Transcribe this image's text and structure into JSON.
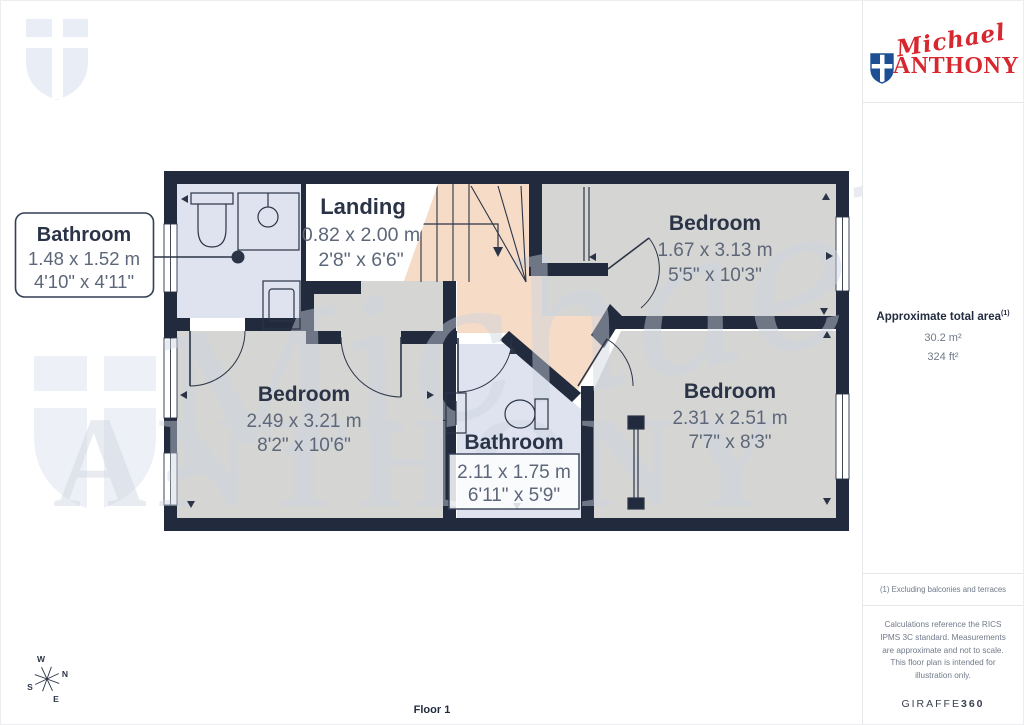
{
  "branding": {
    "script": "Michael",
    "name": "ANTHONY",
    "logo_red": "#d7282f",
    "shield_navy": "#1d4f94"
  },
  "sidebar": {
    "area": {
      "title": "Approximate total area",
      "sup": "(1)",
      "m2": "30.2 m²",
      "ft2": "324 ft²"
    },
    "footnote": "(1) Excluding balconies and terraces",
    "disclaimer": "Calculations reference the RICS IPMS 3C standard. Measurements are approximate and not to scale. This floor plan is intended for illustration only.",
    "provider": {
      "name": "GIRAFFE",
      "suffix": "360"
    }
  },
  "floor": {
    "label": "Floor 1"
  },
  "compass": {
    "n": "N",
    "s": "S",
    "e": "E",
    "w": "W"
  },
  "watermark": {
    "script": "Michael",
    "name": "ANTHONY"
  },
  "rooms": [
    {
      "id": "bathroom-ensuite",
      "name": "Bathroom",
      "metric": "1.48 x 1.52 m",
      "imperial": "4'10\" x 4'11\""
    },
    {
      "id": "landing",
      "name": "Landing",
      "metric": "0.82 x 2.00 m",
      "imperial": "2'8\" x 6'6\""
    },
    {
      "id": "bedroom-top-right",
      "name": "Bedroom",
      "metric": "1.67 x 3.13 m",
      "imperial": "5'5\" x 10'3\""
    },
    {
      "id": "bedroom-left",
      "name": "Bedroom",
      "metric": "2.49 x 3.21 m",
      "imperial": "8'2\" x 10'6\""
    },
    {
      "id": "bathroom-main",
      "name": "Bathroom",
      "metric": "2.11 x 1.75 m",
      "imperial": "6'11\" x 5'9\""
    },
    {
      "id": "bedroom-bottom-right",
      "name": "Bedroom",
      "metric": "2.31 x 2.51 m",
      "imperial": "7'7\" x 8'3\""
    }
  ],
  "colors": {
    "wall": "#222b3d",
    "bedroom_floor": "#d5d5d3",
    "bathroom_floor": "#dee3ef",
    "landing_floor": "#f6dbc6",
    "label_navy": "#2b3447",
    "dim_grey": "#5d6779",
    "watermark": "#cdd4e0"
  }
}
